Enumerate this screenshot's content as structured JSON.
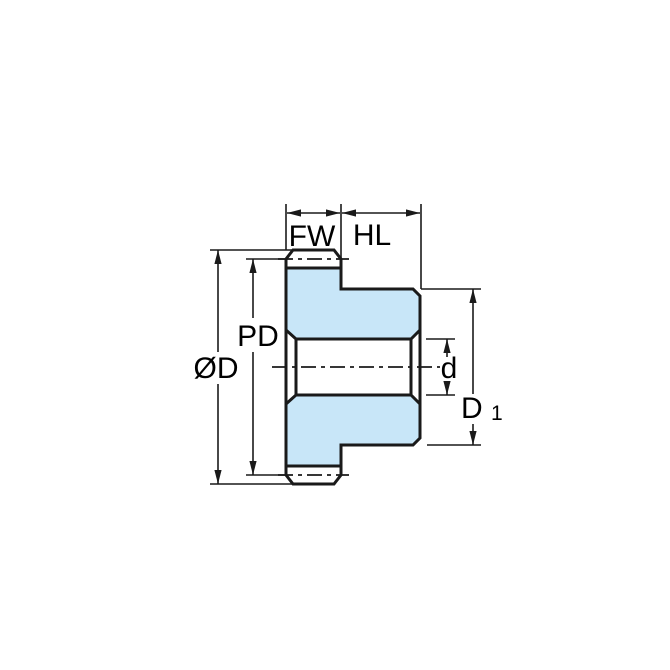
{
  "diagram": {
    "type": "spur-gear-cross-section-dimension-drawing",
    "labels": {
      "face_width": "FW",
      "hub_length": "HL",
      "pitch_diameter": "PD",
      "outside_diameter": "ØD",
      "bore_diameter": "d",
      "hub_diameter_base": "D",
      "hub_diameter_sub": "1"
    },
    "colors": {
      "part_fill": "#C8E6F8",
      "line": "#1A1A1A",
      "background": "#FFFFFF"
    }
  }
}
